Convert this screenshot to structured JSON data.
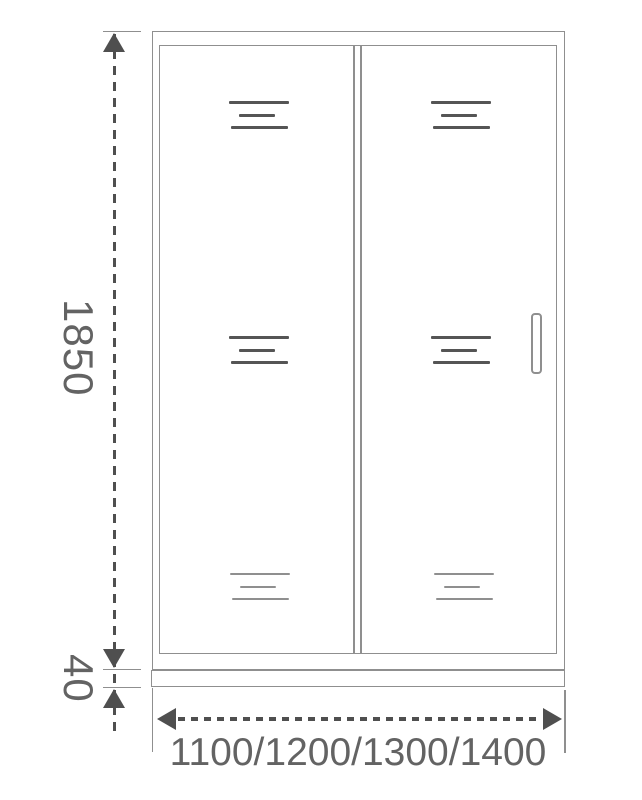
{
  "drawing": {
    "labels": {
      "height": "1850",
      "base_height": "40",
      "width_options": "1100/1200/1300/1400"
    },
    "colors": {
      "bg": "#ffffff",
      "line": "#8f8f8f",
      "dark": "#4f4f4f",
      "mark": "#555555",
      "text": "#636363"
    }
  }
}
